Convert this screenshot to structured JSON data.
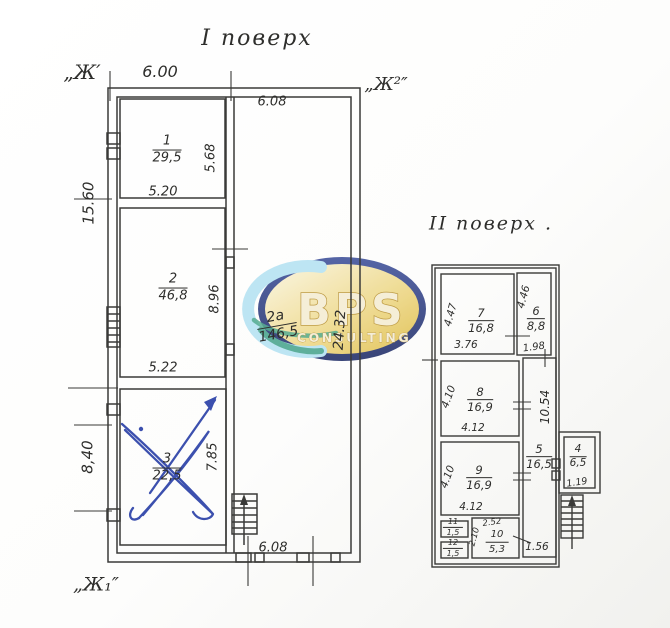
{
  "watermark": {
    "text": "BPS",
    "subtext": "CONSULTING",
    "colors": {
      "ring": "#24336f",
      "gold": "#dfbc45",
      "cream": "#fbf6e2",
      "crescent": "#b5e2f2",
      "swirl": "#3fa182",
      "letters": "#f4ecd2"
    }
  },
  "floor1": {
    "title": "I поверх",
    "corner_labels": {
      "top_left": "„Ж′",
      "top_right": "„Ж²″",
      "bottom_left": "„Ж₁″"
    },
    "dims": {
      "top_width": "6.00",
      "hall_top_width": "6.08",
      "left_upper": "15.60",
      "left_lower": "8,40",
      "room1_width": "5.20",
      "room1_height": "5.68",
      "room2_width": "5.22",
      "room2_height": "8.96",
      "room3_height": "7.85",
      "hall_height": "24.32",
      "bottom_width": "6.08"
    },
    "rooms": [
      {
        "num": "1",
        "area": "29,5"
      },
      {
        "num": "2",
        "area": "46,8"
      },
      {
        "num": "3",
        "area": "22,5"
      },
      {
        "num": "2а",
        "area": "146,5"
      }
    ]
  },
  "floor2": {
    "title": "II поверх .",
    "rooms": [
      {
        "num": "4",
        "area": "6,5"
      },
      {
        "num": "5",
        "area": "16,5"
      },
      {
        "num": "6",
        "area": "8,8"
      },
      {
        "num": "7",
        "area": "16,8"
      },
      {
        "num": "8",
        "area": "16,9"
      },
      {
        "num": "9",
        "area": "16,9"
      },
      {
        "num": "10",
        "area": "5,3"
      },
      {
        "num": "11",
        "area": "1,5"
      },
      {
        "num": "12",
        "area": "1,5"
      }
    ],
    "dims": {
      "room7_h": "4.47",
      "room7_w": "3.76",
      "room6_h": "4.46",
      "room6_w": "1.98",
      "room8_h": "4.10",
      "room8_w": "4.12",
      "room9_h": "4.10",
      "room9_w": "4.12",
      "corridor_h": "10.54",
      "room4_w": "1.19",
      "room10_w": "2.52",
      "room10_h": "2.10",
      "bottom_right": "1.56"
    }
  }
}
